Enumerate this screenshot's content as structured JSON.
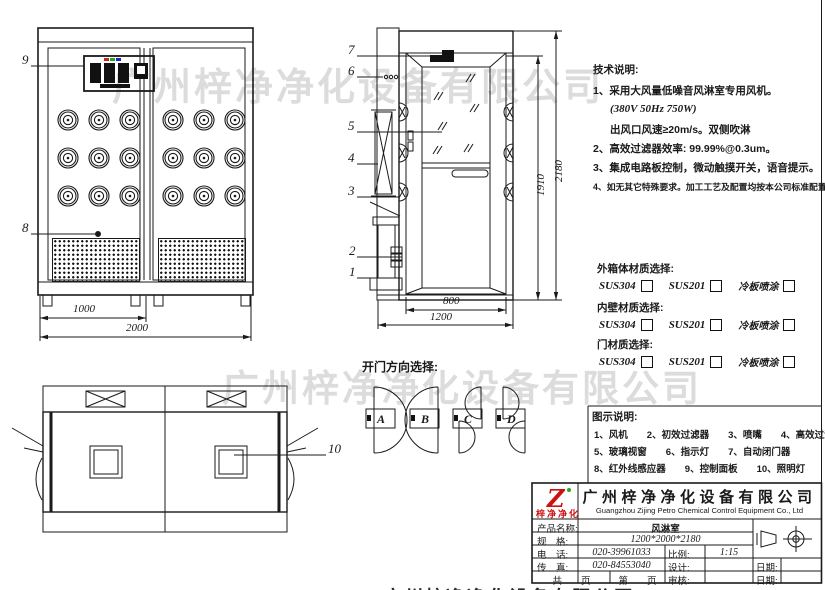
{
  "watermark": {
    "text": "广州梓净净化设备有限公司",
    "bottom_clipped": "广州梓净净化设备有限公司"
  },
  "labels": {
    "n1": "1",
    "n2": "2",
    "n3": "3",
    "n4": "4",
    "n5": "5",
    "n6": "6",
    "n7": "7",
    "n8": "8",
    "n9": "9",
    "n10": "10"
  },
  "dims": {
    "d1000": "1000",
    "d2000": "2000",
    "d800": "800",
    "d1200": "1200",
    "d1910": "1910",
    "d2180": "2180"
  },
  "door_options": {
    "title": "开门方向选择:",
    "a": "A",
    "b": "B",
    "c": "C",
    "d": "D"
  },
  "tech_notes": {
    "title": "技术说明:",
    "line1": "1、采用大风量低噪音风淋室专用风机。",
    "line2": "(380V 50Hz  750W)",
    "line3": "出风口风速≥20m/s。双侧吹淋",
    "line4": "2、高效过滤器效率: 99.99%@0.3um。",
    "line5": "3、集成电路板控制，微动触摸开关，语音提示。",
    "line6": "4、如无其它特殊要求。加工工艺及配置均按本公司标准配置。"
  },
  "materials": {
    "group1": "外箱体材质选择:",
    "group2": "内壁材质选择:",
    "group3": "门材质选择:",
    "opt1": "SUS304",
    "opt2": "SUS201",
    "opt3": "冷板喷涂"
  },
  "legend": {
    "title": "图示说明:",
    "line1": "1、风机　　2、初效过滤器　　3、喷嘴　　4、高效过滤器",
    "line2": "5、玻璃视窗　　6、指示灯　　7、自动闭门器",
    "line3": "8、红外线感应器　　9、控制面板　　10、照明灯"
  },
  "title_block": {
    "logo_text": "梓净净化",
    "company_cn": "广州梓净净化设备有限公司",
    "company_en": "Guangzhou Zijing Petro Chemical Control Equipment Co., Ltd",
    "product_label": "产品名称:",
    "product_value": "风淋室",
    "spec_label": "规　格:",
    "spec_value": "1200*2000*2180",
    "tel_label": "电　话:",
    "tel_value": "020-39961033",
    "scale_label": "比例:",
    "scale_value": "1:15",
    "fax_label": "传　真:",
    "fax_value": "020-84553040",
    "design_label": "设计:",
    "date_label1": "日期:",
    "pages_label1": "共　　页",
    "pages_label2": "第　　页",
    "audit_label": "审核:",
    "date_label2": "日期:"
  },
  "colors": {
    "line": "#1a1a1a",
    "watermark": "#dcdcdc",
    "logo_red": "#cc1111"
  }
}
